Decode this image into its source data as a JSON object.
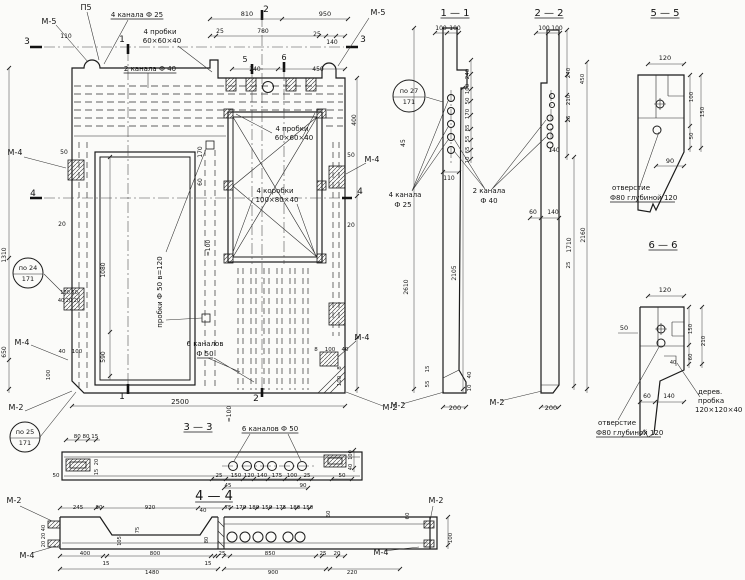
{
  "meta": {
    "kind": "engineering-working-drawing",
    "language": "ru",
    "description": "Precast concrete panel working drawing with main view, sections 1-1, 2-2, 3-3, 4-4 and details 5-5, 6-6",
    "line_color": "#1b1b1b",
    "paper_color": "#fbfbf9"
  },
  "sections": {
    "titles": [
      "1 — 1",
      "2 — 2",
      "5 — 5",
      "6 — 6",
      "3 — 3",
      "4 — 4"
    ],
    "embed_marks": [
      "М-5",
      "М-4",
      "М-2",
      "П5"
    ],
    "callouts": [
      "по 24 / 171",
      "по 25 / 171",
      "по 27 / 171"
    ],
    "notes": [
      "4 канала Ф 25",
      "2 канала Ф 40",
      "4 пробки 60×60×40",
      "4 коробки 100×80×40",
      "пробки Ф 50 в=120",
      "6 каналов Ф 50",
      "2 канала Ф 40",
      "отверстие Ф80 глубиной 120",
      "дерев. пробка 120×120×40"
    ],
    "overall_dims": [
      "2500",
      "2610",
      "2105",
      "2160",
      "1710",
      "1480",
      "1310",
      "1080",
      "950",
      "920",
      "900",
      "850",
      "810",
      "800",
      "780",
      "650",
      "590",
      "450",
      "400"
    ]
  },
  "texts": [
    {
      "t": "М-5",
      "x": 49,
      "y": 24,
      "s": 8,
      "n": "mark-m5-top-left"
    },
    {
      "t": "П5",
      "x": 86,
      "y": 10,
      "s": 8,
      "n": "mark-p5"
    },
    {
      "t": "4 канала Ф 25",
      "x": 137,
      "y": 17,
      "u": 1,
      "n": "note-4-channels-f25"
    },
    {
      "t": "110",
      "x": 66,
      "y": 38,
      "s": 6
    },
    {
      "t": "3",
      "x": 27,
      "y": 44,
      "s": 9,
      "n": "cut-mark-3-left"
    },
    {
      "t": "1",
      "x": 122,
      "y": 42,
      "s": 9,
      "n": "cut-mark-1-top"
    },
    {
      "t": "4 пробки",
      "x": 160,
      "y": 34,
      "n": "note-4-probki-top"
    },
    {
      "t": "60×60×40",
      "x": 162,
      "y": 43
    },
    {
      "t": "2 канала Ф 40",
      "x": 150,
      "y": 71,
      "u": 1,
      "n": "note-2-channels-f40"
    },
    {
      "t": "810",
      "x": 247,
      "y": 16,
      "s": 6.5
    },
    {
      "t": "950",
      "x": 325,
      "y": 16,
      "s": 6.5
    },
    {
      "t": "2",
      "x": 266,
      "y": 12,
      "s": 9,
      "n": "cut-mark-2-top"
    },
    {
      "t": "25",
      "x": 220,
      "y": 33,
      "s": 6
    },
    {
      "t": "780",
      "x": 263,
      "y": 33,
      "s": 6
    },
    {
      "t": "25",
      "x": 317,
      "y": 36,
      "s": 6
    },
    {
      "t": "140",
      "x": 332,
      "y": 44,
      "s": 6
    },
    {
      "t": "М-5",
      "x": 378,
      "y": 15,
      "s": 8,
      "n": "mark-m5-top-right"
    },
    {
      "t": "3",
      "x": 363,
      "y": 42,
      "s": 9,
      "n": "cut-mark-3-right"
    },
    {
      "t": "5",
      "x": 245,
      "y": 62,
      "s": 8,
      "n": "cut-mark-5"
    },
    {
      "t": "6",
      "x": 284,
      "y": 60,
      "s": 8,
      "n": "cut-mark-6"
    },
    {
      "t": "240",
      "x": 255,
      "y": 71,
      "s": 6
    },
    {
      "t": "450",
      "x": 318,
      "y": 71,
      "s": 6
    },
    {
      "t": "4 пробки",
      "x": 292,
      "y": 131
    },
    {
      "t": "60×60×40",
      "x": 294,
      "y": 140
    },
    {
      "t": "4 коробки",
      "x": 275,
      "y": 193,
      "n": "note-4-korobki"
    },
    {
      "t": "100×80×40",
      "x": 277,
      "y": 202
    },
    {
      "t": "М-4",
      "x": 15,
      "y": 155,
      "s": 8,
      "n": "mark-m4-left-upper"
    },
    {
      "t": "50",
      "x": 64,
      "y": 154,
      "s": 6
    },
    {
      "t": "4",
      "x": 33,
      "y": 196,
      "s": 9,
      "n": "cut-mark-4-left"
    },
    {
      "t": "20",
      "x": 62,
      "y": 226,
      "s": 6
    },
    {
      "t": "1310",
      "x": 6,
      "y": 255,
      "r": 1,
      "s": 6
    },
    {
      "t": "по 24",
      "x": 28,
      "y": 270,
      "s": 6.5,
      "n": "callout-po24"
    },
    {
      "t": "171",
      "x": 28,
      "y": 281,
      "s": 6.5
    },
    {
      "t": "100 50",
      "x": 69,
      "y": 294,
      "s": 5
    },
    {
      "t": "40 20 20",
      "x": 69,
      "y": 302,
      "s": 5
    },
    {
      "t": "М-4",
      "x": 22,
      "y": 345,
      "s": 8,
      "n": "mark-m4-left-lower"
    },
    {
      "t": "650",
      "x": 6,
      "y": 352,
      "r": 1,
      "s": 6
    },
    {
      "t": "М-2",
      "x": 16,
      "y": 410,
      "s": 8,
      "n": "mark-m2-bottom-left"
    },
    {
      "t": "по 25",
      "x": 25,
      "y": 434,
      "s": 6.5,
      "n": "callout-po25"
    },
    {
      "t": "171",
      "x": 25,
      "y": 445,
      "s": 6.5
    },
    {
      "t": "40",
      "x": 62,
      "y": 353,
      "s": 5.5
    },
    {
      "t": "100",
      "x": 77,
      "y": 353,
      "s": 5.5
    },
    {
      "t": "100",
      "x": 50,
      "y": 375,
      "r": 1,
      "s": 5.5
    },
    {
      "t": "пробки Ф 50  в=120",
      "x": 162,
      "y": 292,
      "r": 1,
      "n": "note-probki-f50"
    },
    {
      "t": "1080",
      "x": 105,
      "y": 270,
      "r": 1,
      "s": 6
    },
    {
      "t": "590",
      "x": 105,
      "y": 357,
      "r": 1,
      "s": 6
    },
    {
      "t": "≈100",
      "x": 210,
      "y": 248,
      "r": 1,
      "s": 6
    },
    {
      "t": "≈100",
      "x": 231,
      "y": 414,
      "r": 1,
      "s": 6
    },
    {
      "t": "6 каналов",
      "x": 205,
      "y": 346,
      "n": "note-6-channels-facade"
    },
    {
      "t": "Ф 50",
      "x": 205,
      "y": 356,
      "u": 1
    },
    {
      "t": "1",
      "x": 122,
      "y": 399,
      "s": 9,
      "n": "cut-mark-1-bottom"
    },
    {
      "t": "2",
      "x": 256,
      "y": 401,
      "s": 9,
      "n": "cut-mark-2-bottom"
    },
    {
      "t": "2500",
      "x": 180,
      "y": 404,
      "s": 7
    },
    {
      "t": "8",
      "x": 316,
      "y": 351,
      "s": 5.5
    },
    {
      "t": "100",
      "x": 330,
      "y": 351,
      "s": 5.5
    },
    {
      "t": "40",
      "x": 345,
      "y": 351,
      "s": 5.5
    },
    {
      "t": "8",
      "x": 341,
      "y": 368,
      "r": 1,
      "s": 5.5
    },
    {
      "t": "100",
      "x": 341,
      "y": 381,
      "r": 1,
      "s": 5.5
    },
    {
      "t": "М-4",
      "x": 362,
      "y": 340,
      "s": 8,
      "n": "mark-m4-right-lower"
    },
    {
      "t": "М-2",
      "x": 390,
      "y": 410,
      "s": 8,
      "n": "mark-m2-bottom-right"
    },
    {
      "t": "400",
      "x": 356,
      "y": 120,
      "r": 1,
      "s": 6
    },
    {
      "t": "50",
      "x": 351,
      "y": 157,
      "s": 6
    },
    {
      "t": "4",
      "x": 360,
      "y": 194,
      "s": 9,
      "n": "cut-mark-4-right"
    },
    {
      "t": "20",
      "x": 351,
      "y": 227,
      "s": 6
    },
    {
      "t": "М-4",
      "x": 372,
      "y": 162,
      "s": 8,
      "n": "mark-m4-right-upper"
    },
    {
      "t": "170",
      "x": 202,
      "y": 152,
      "r": 1,
      "s": 6
    },
    {
      "t": "60",
      "x": 202,
      "y": 182,
      "r": 1,
      "s": 6
    },
    {
      "t": "1 — 1",
      "x": 455,
      "y": 16,
      "s": 10,
      "u": 1,
      "n": "section-title-1-1"
    },
    {
      "t": "100",
      "x": 441,
      "y": 30,
      "s": 6
    },
    {
      "t": "100",
      "x": 455,
      "y": 30,
      "s": 6
    },
    {
      "t": "240",
      "x": 469,
      "y": 74,
      "r": 1,
      "s": 5.5
    },
    {
      "t": "100",
      "x": 469,
      "y": 89,
      "r": 1,
      "s": 5.5
    },
    {
      "t": "50",
      "x": 469,
      "y": 101,
      "r": 1,
      "s": 5.5
    },
    {
      "t": "170",
      "x": 469,
      "y": 114,
      "r": 1,
      "s": 5.5
    },
    {
      "t": "85",
      "x": 469,
      "y": 128,
      "r": 1,
      "s": 5.5
    },
    {
      "t": "55",
      "x": 469,
      "y": 139,
      "r": 1,
      "s": 5.5
    },
    {
      "t": "65",
      "x": 469,
      "y": 150,
      "r": 1,
      "s": 5.5
    },
    {
      "t": "10",
      "x": 469,
      "y": 160,
      "r": 1,
      "s": 5.5
    },
    {
      "t": "110",
      "x": 449,
      "y": 180,
      "s": 6
    },
    {
      "t": "45",
      "x": 405,
      "y": 143,
      "r": 1,
      "s": 6
    },
    {
      "t": "по 27",
      "x": 409,
      "y": 93,
      "s": 6.5,
      "n": "callout-po27"
    },
    {
      "t": "171",
      "x": 409,
      "y": 104,
      "s": 6.5
    },
    {
      "t": "4 канала",
      "x": 405,
      "y": 197,
      "n": "note-4-channels-sec"
    },
    {
      "t": "Ф 25",
      "x": 403,
      "y": 207
    },
    {
      "t": "2 канала",
      "x": 489,
      "y": 193,
      "n": "note-2-channels-sec"
    },
    {
      "t": "Ф 40",
      "x": 489,
      "y": 203
    },
    {
      "t": "2610",
      "x": 408,
      "y": 287,
      "r": 1,
      "s": 6
    },
    {
      "t": "2105",
      "x": 456,
      "y": 273,
      "r": 1,
      "s": 6
    },
    {
      "t": "15",
      "x": 429,
      "y": 369,
      "r": 1,
      "s": 5.5
    },
    {
      "t": "55",
      "x": 429,
      "y": 384,
      "r": 1,
      "s": 5.5
    },
    {
      "t": "40",
      "x": 471,
      "y": 375,
      "r": 1,
      "s": 5.5
    },
    {
      "t": "10",
      "x": 471,
      "y": 388,
      "r": 1,
      "s": 5.5
    },
    {
      "t": "200",
      "x": 455,
      "y": 410,
      "s": 6.5
    },
    {
      "t": "М-2",
      "x": 398,
      "y": 408,
      "s": 8,
      "n": "mark-m2-sec11"
    },
    {
      "t": "2 — 2",
      "x": 549,
      "y": 16,
      "s": 10,
      "u": 1,
      "n": "section-title-2-2"
    },
    {
      "t": "100",
      "x": 544,
      "y": 30,
      "s": 6
    },
    {
      "t": "100",
      "x": 557,
      "y": 30,
      "s": 6
    },
    {
      "t": "240",
      "x": 570,
      "y": 73,
      "r": 1,
      "s": 5.5
    },
    {
      "t": "450",
      "x": 584,
      "y": 79,
      "r": 1,
      "s": 5.5
    },
    {
      "t": "210",
      "x": 570,
      "y": 100,
      "r": 1,
      "s": 5.5
    },
    {
      "t": "25",
      "x": 570,
      "y": 119,
      "r": 1,
      "s": 5.5
    },
    {
      "t": "140",
      "x": 554,
      "y": 152,
      "s": 6
    },
    {
      "t": "1710",
      "x": 571,
      "y": 245,
      "r": 1,
      "s": 6
    },
    {
      "t": "2160",
      "x": 585,
      "y": 235,
      "r": 1,
      "s": 6
    },
    {
      "t": "60",
      "x": 533,
      "y": 214,
      "s": 6
    },
    {
      "t": "140",
      "x": 553,
      "y": 214,
      "s": 6
    },
    {
      "t": "25",
      "x": 570,
      "y": 265,
      "r": 1,
      "s": 5.5
    },
    {
      "t": "200",
      "x": 551,
      "y": 410,
      "s": 6.5
    },
    {
      "t": "М-2",
      "x": 497,
      "y": 405,
      "s": 8,
      "n": "mark-m2-sec22"
    },
    {
      "t": "5 — 5",
      "x": 665,
      "y": 16,
      "s": 10,
      "u": 1,
      "n": "section-title-5-5"
    },
    {
      "t": "120",
      "x": 665,
      "y": 60,
      "s": 6.5
    },
    {
      "t": "100",
      "x": 693,
      "y": 97,
      "r": 1,
      "s": 5.5
    },
    {
      "t": "50",
      "x": 693,
      "y": 136,
      "r": 1,
      "s": 5.5
    },
    {
      "t": "150",
      "x": 704,
      "y": 112,
      "r": 1,
      "s": 5.5
    },
    {
      "t": "90",
      "x": 670,
      "y": 163,
      "s": 6.5
    },
    {
      "t": "отверстие",
      "x": 612,
      "y": 190,
      "a": 1,
      "n": "note-otverstie-55"
    },
    {
      "t": "Ф80 глубиной 120",
      "x": 610,
      "y": 200,
      "a": 1,
      "u": 1
    },
    {
      "t": "6 — 6",
      "x": 663,
      "y": 248,
      "s": 10,
      "u": 1,
      "n": "section-title-6-6"
    },
    {
      "t": "120",
      "x": 665,
      "y": 292,
      "s": 6.5
    },
    {
      "t": "50",
      "x": 624,
      "y": 330,
      "s": 6.5
    },
    {
      "t": "150",
      "x": 692,
      "y": 329,
      "r": 1,
      "s": 5.5
    },
    {
      "t": "60",
      "x": 692,
      "y": 357,
      "r": 1,
      "s": 5.5
    },
    {
      "t": "210",
      "x": 705,
      "y": 341,
      "r": 1,
      "s": 5.5
    },
    {
      "t": "40",
      "x": 673,
      "y": 364,
      "s": 5
    },
    {
      "t": "60",
      "x": 647,
      "y": 398,
      "s": 6
    },
    {
      "t": "140",
      "x": 669,
      "y": 398,
      "s": 6
    },
    {
      "t": "дерев.",
      "x": 698,
      "y": 394,
      "a": 1,
      "n": "note-derev-probka"
    },
    {
      "t": "пробка",
      "x": 698,
      "y": 403,
      "a": 1
    },
    {
      "t": "120×120×40",
      "x": 695,
      "y": 412,
      "a": 1
    },
    {
      "t": "отверстие",
      "x": 598,
      "y": 425,
      "a": 1,
      "n": "note-otverstie-66"
    },
    {
      "t": "Ф80 глубиной 120",
      "x": 596,
      "y": 435,
      "a": 1,
      "u": 1
    },
    {
      "t": "3 — 3",
      "x": 198,
      "y": 430,
      "s": 10,
      "u": 1,
      "n": "section-title-3-3"
    },
    {
      "t": "6 каналов Ф 50",
      "x": 270,
      "y": 431,
      "u": 1,
      "n": "note-6-channels-33"
    },
    {
      "t": "80 80 15",
      "x": 86,
      "y": 438,
      "s": 5.5
    },
    {
      "t": "20",
      "x": 98,
      "y": 462,
      "r": 1,
      "s": 5
    },
    {
      "t": "15",
      "x": 98,
      "y": 472,
      "r": 1,
      "s": 5
    },
    {
      "t": "25",
      "x": 219,
      "y": 477,
      "s": 5.5
    },
    {
      "t": "150",
      "x": 236,
      "y": 477,
      "s": 5.5
    },
    {
      "t": "120",
      "x": 249,
      "y": 477,
      "s": 5.5
    },
    {
      "t": "140",
      "x": 262,
      "y": 477,
      "s": 5.5
    },
    {
      "t": "175",
      "x": 277,
      "y": 477,
      "s": 5.5
    },
    {
      "t": "100",
      "x": 292,
      "y": 477,
      "s": 5.5
    },
    {
      "t": "25",
      "x": 307,
      "y": 477,
      "s": 5.5
    },
    {
      "t": "45",
      "x": 228,
      "y": 487,
      "s": 5.5
    },
    {
      "t": "90",
      "x": 303,
      "y": 487,
      "s": 5.5
    },
    {
      "t": "50",
      "x": 342,
      "y": 477,
      "s": 5.5
    },
    {
      "t": "50",
      "x": 56,
      "y": 477,
      "s": 5.5
    },
    {
      "t": "100",
      "x": 352,
      "y": 455,
      "r": 1,
      "s": 5
    },
    {
      "t": "40",
      "x": 352,
      "y": 467,
      "r": 1,
      "s": 5
    },
    {
      "t": "4 — 4",
      "x": 214,
      "y": 500,
      "s": 13,
      "u": 1,
      "n": "section-title-4-4"
    },
    {
      "t": "М-2",
      "x": 14,
      "y": 503,
      "s": 8,
      "n": "mark-m2-44-left"
    },
    {
      "t": "М-4",
      "x": 27,
      "y": 558,
      "s": 8,
      "n": "mark-m4-44-left"
    },
    {
      "t": "М-2",
      "x": 436,
      "y": 503,
      "s": 8,
      "n": "mark-m2-44-right"
    },
    {
      "t": "М-4",
      "x": 381,
      "y": 555,
      "s": 8,
      "n": "mark-m4-44-right"
    },
    {
      "t": "245",
      "x": 78,
      "y": 509,
      "s": 5.5
    },
    {
      "t": "90",
      "x": 99,
      "y": 509,
      "s": 5.5
    },
    {
      "t": "920",
      "x": 150,
      "y": 509,
      "s": 5.5
    },
    {
      "t": "40",
      "x": 203,
      "y": 512,
      "s": 5.5
    },
    {
      "t": "75",
      "x": 228,
      "y": 509,
      "s": 5.5
    },
    {
      "t": "170",
      "x": 241,
      "y": 509,
      "s": 5.5
    },
    {
      "t": "180",
      "x": 254,
      "y": 509,
      "s": 5.5
    },
    {
      "t": "150",
      "x": 267,
      "y": 509,
      "s": 5.5
    },
    {
      "t": "175",
      "x": 281,
      "y": 509,
      "s": 5.5
    },
    {
      "t": "180",
      "x": 295,
      "y": 509,
      "s": 5.5
    },
    {
      "t": "150",
      "x": 308,
      "y": 509,
      "s": 5.5
    },
    {
      "t": "60",
      "x": 330,
      "y": 514,
      "r": 1,
      "s": 5.5
    },
    {
      "t": "60",
      "x": 409,
      "y": 516,
      "r": 1,
      "s": 5.5
    },
    {
      "t": "100",
      "x": 452,
      "y": 538,
      "r": 1,
      "s": 5.5
    },
    {
      "t": "40",
      "x": 45,
      "y": 528,
      "r": 1,
      "s": 5
    },
    {
      "t": "20",
      "x": 45,
      "y": 536,
      "r": 1,
      "s": 5
    },
    {
      "t": "20",
      "x": 45,
      "y": 544,
      "r": 1,
      "s": 5
    },
    {
      "t": "75",
      "x": 139,
      "y": 530,
      "r": 1,
      "s": 5
    },
    {
      "t": "105",
      "x": 121,
      "y": 541,
      "r": 1,
      "s": 5
    },
    {
      "t": "80",
      "x": 208,
      "y": 540,
      "r": 1,
      "s": 5
    },
    {
      "t": "400",
      "x": 85,
      "y": 555,
      "s": 5.5
    },
    {
      "t": "800",
      "x": 155,
      "y": 555,
      "s": 5.5
    },
    {
      "t": "15",
      "x": 106,
      "y": 565,
      "s": 5.5
    },
    {
      "t": "15",
      "x": 208,
      "y": 565,
      "s": 5.5
    },
    {
      "t": "1480",
      "x": 152,
      "y": 574,
      "s": 5.5
    },
    {
      "t": "25",
      "x": 222,
      "y": 555,
      "s": 5.5
    },
    {
      "t": "850",
      "x": 270,
      "y": 555,
      "s": 5.5
    },
    {
      "t": "25",
      "x": 323,
      "y": 555,
      "s": 5.5
    },
    {
      "t": "20",
      "x": 337,
      "y": 555,
      "s": 5.5
    },
    {
      "t": "900",
      "x": 273,
      "y": 574,
      "s": 5.5
    },
    {
      "t": "220",
      "x": 352,
      "y": 574,
      "s": 5.5
    }
  ]
}
